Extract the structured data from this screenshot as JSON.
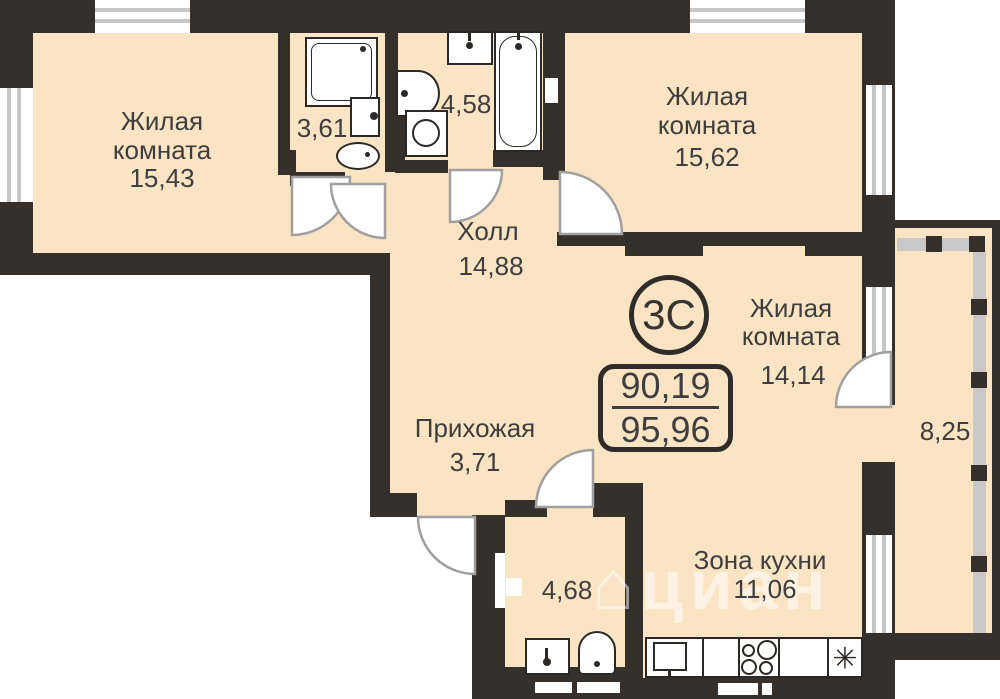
{
  "plan": {
    "badge": {
      "label": "3С"
    },
    "area_box": {
      "top": "90,19",
      "bottom": "95,96"
    },
    "rooms": [
      {
        "key": "living-room-1",
        "line1": "Жилая",
        "line2": "комната",
        "area": "15,43"
      },
      {
        "key": "bathroom-1",
        "area": "3,61"
      },
      {
        "key": "bathroom-2",
        "area": "4,58"
      },
      {
        "key": "living-room-2",
        "line1": "Жилая",
        "line2": "комната",
        "area": "15,62"
      },
      {
        "key": "hall",
        "line1": "Холл",
        "area": "14,88"
      },
      {
        "key": "living-room-3",
        "line1": "Жилая",
        "line2": "комната",
        "area": "14,14"
      },
      {
        "key": "entry",
        "line1": "Прихожая",
        "area": "3,71"
      },
      {
        "key": "wc",
        "area": "4,68"
      },
      {
        "key": "kitchen-zone",
        "line1": "Зона кухни",
        "area": "11,06"
      },
      {
        "key": "balcony",
        "area": "8,25"
      }
    ],
    "fridge_symbol": "✳",
    "watermark": {
      "icon": "⌂",
      "text": "циан"
    }
  },
  "colors": {
    "wall": "#35302c",
    "room_fill": "#fbe4c4",
    "glazing": "#c9c9c9",
    "door_arc": "#a0a0a0",
    "text": "#3e3e3e"
  }
}
